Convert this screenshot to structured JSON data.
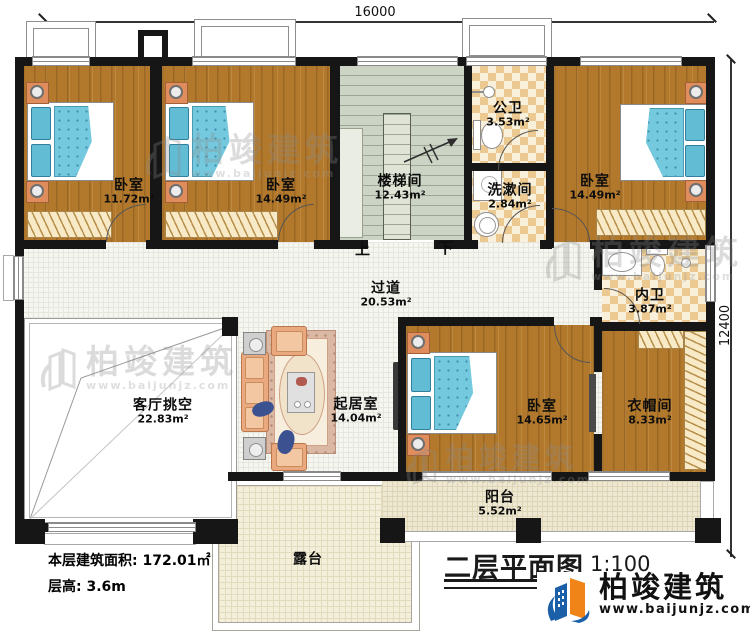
{
  "title_block": {
    "title": "二层平面图",
    "scale": "1:100"
  },
  "stats": {
    "area_label": "本层建筑面积:",
    "area_value": "172.01㎡",
    "height_label": "层高:",
    "height_value": "3.6m"
  },
  "dimensions": {
    "width_mm": "16000",
    "depth_mm": "12400"
  },
  "stairs": {
    "up_label": "上",
    "down_label": "下"
  },
  "brand": {
    "name": "柏竣建筑",
    "website": "www.baijunjz.com"
  },
  "rooms": [
    {
      "id": "bedroom-1",
      "name": "卧室",
      "area": "11.72m²"
    },
    {
      "id": "bedroom-2",
      "name": "卧室",
      "area": "14.49m²"
    },
    {
      "id": "stairwell",
      "name": "楼梯间",
      "area": "12.43m²"
    },
    {
      "id": "public-bathroom",
      "name": "公卫",
      "area": "3.53m²"
    },
    {
      "id": "washroom",
      "name": "洗漱间",
      "area": "2.84m²"
    },
    {
      "id": "bedroom-3",
      "name": "卧室",
      "area": "14.49m²"
    },
    {
      "id": "inner-bathroom",
      "name": "内卫",
      "area": "3.87m²"
    },
    {
      "id": "corridor",
      "name": "过道",
      "area": "20.53m²"
    },
    {
      "id": "living-room-void",
      "name": "客厅挑空",
      "area": "22.83m²"
    },
    {
      "id": "sitting-room",
      "name": "起居室",
      "area": "14.04m²"
    },
    {
      "id": "bedroom-4",
      "name": "卧室",
      "area": "14.65m²"
    },
    {
      "id": "cloakroom",
      "name": "衣帽间",
      "area": "8.33m²"
    },
    {
      "id": "balcony",
      "name": "阳台",
      "area": "5.52m²"
    },
    {
      "id": "terrace",
      "name": "露台",
      "area": ""
    }
  ]
}
